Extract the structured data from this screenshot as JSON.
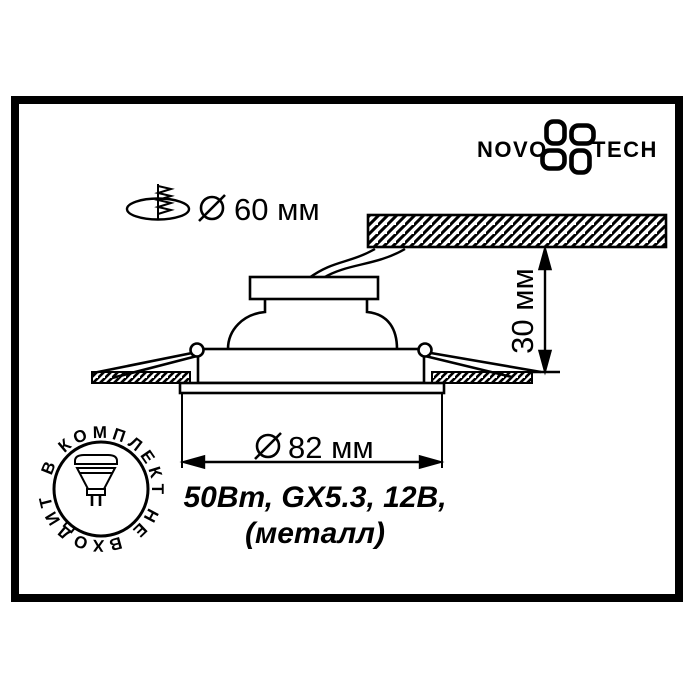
{
  "colors": {
    "ink": "#000000",
    "paper": "#ffffff"
  },
  "logo": {
    "left": "NOVO",
    "right": "TECH"
  },
  "icons": {
    "logo_flower": "novotech-flower-icon",
    "cutout": "ceiling-cutout-icon",
    "diameter": "diameter-icon",
    "lamp": "mr16-lamp-icon"
  },
  "cutout_note": {
    "value": "60 мм"
  },
  "dimensions": {
    "recess_depth": "30 мм",
    "flange_diameter": "82 мм"
  },
  "specs": {
    "line1": "50Вт, GX5.3, 12В,",
    "line2": "(металл)"
  },
  "stamp": {
    "circular_text": "В КОМПЛЕКТ НЕ ВХОДИТ"
  }
}
